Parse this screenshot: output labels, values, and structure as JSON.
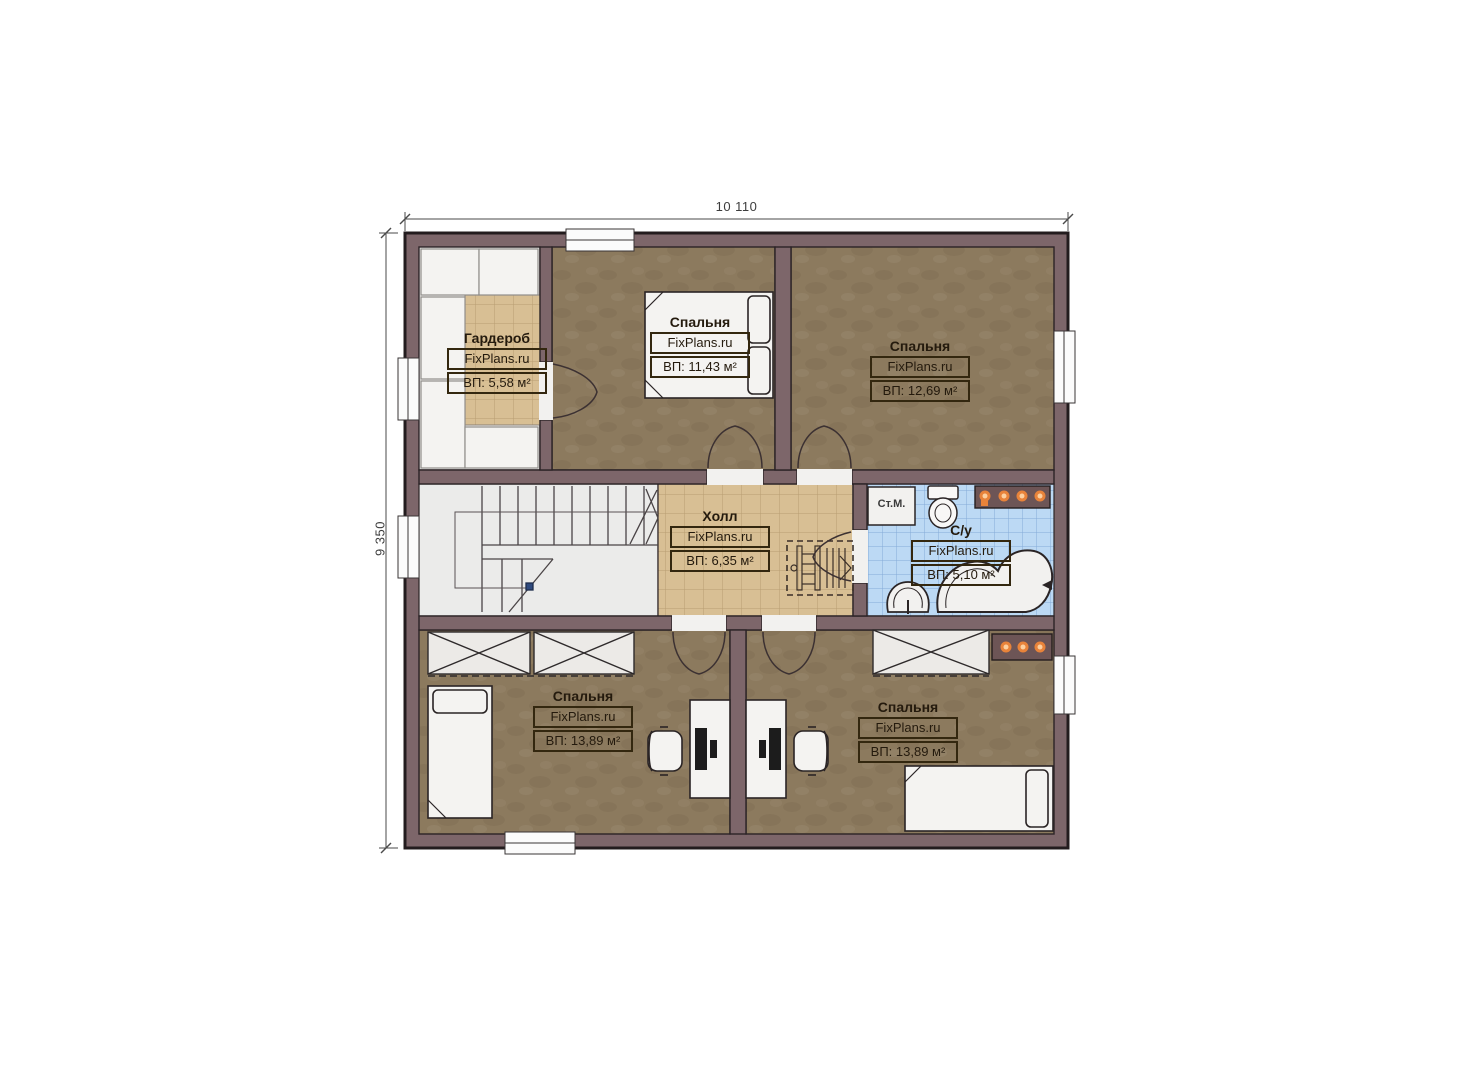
{
  "plan": {
    "dimensions": {
      "width_label": "10 110",
      "height_label": "9 350"
    },
    "rooms": [
      {
        "name": "Гардероб",
        "brand": "FixPlans.ru",
        "area": "ВП: 5,58 м²"
      },
      {
        "name": "Спальня",
        "brand": "FixPlans.ru",
        "area": "ВП: 11,43 м²"
      },
      {
        "name": "Спальня",
        "brand": "FixPlans.ru",
        "area": "ВП: 12,69 м²"
      },
      {
        "name": "Холл",
        "brand": "FixPlans.ru",
        "area": "ВП: 6,35 м²"
      },
      {
        "name": "С/у",
        "brand": "FixPlans.ru",
        "area": "ВП: 5,10 м²"
      },
      {
        "name": "Спальня",
        "brand": "FixPlans.ru",
        "area": "ВП: 13,89 м²"
      },
      {
        "name": "Спальня",
        "brand": "FixPlans.ru",
        "area": "ВП: 13,89 м²"
      }
    ],
    "fixtures": {
      "washing_machine": "Ст.М."
    },
    "colors": {
      "wall": "#7d666a",
      "floor_wood": "#8c7a5e",
      "floor_tile": "#d8bf94",
      "floor_bath": "#bcd9f4",
      "stair_floor": "#ebebea",
      "light_accent": "#e8833a"
    }
  }
}
